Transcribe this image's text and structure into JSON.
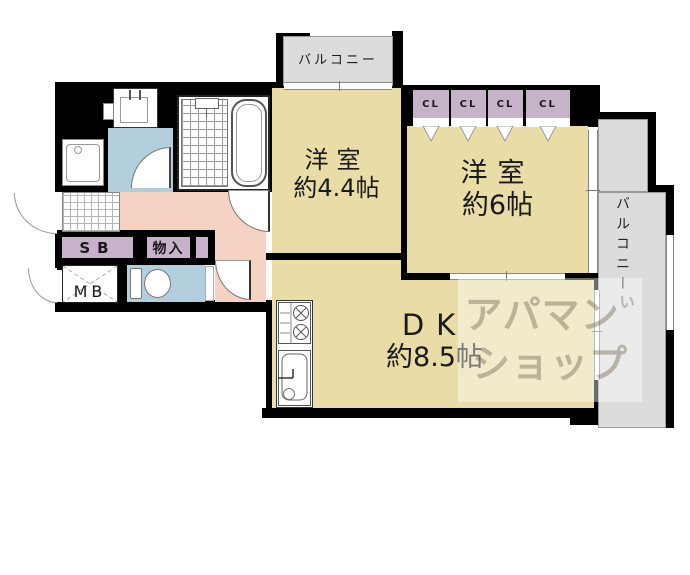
{
  "colors": {
    "wall": "#000000",
    "room": "#e9dca6",
    "closet": "#c6b2c9",
    "water": "#b3cedd",
    "hall": "#f5d2c2",
    "balcony": "#dcdcdc",
    "watermark_ink": "rgba(105,95,75,0.40)",
    "watermark_bg": "rgba(255,255,255,0.42)"
  },
  "labels": {
    "balcony_top": "バルコニー",
    "balcony_right": "バルコニー",
    "room_small_name": "洋室",
    "room_small_size": "約4.4帖",
    "room_large_name": "洋室",
    "room_large_size": "約6帖",
    "dk_name": "DK",
    "dk_size": "約8.5帖",
    "shoe_box": "SB",
    "storage": "物入",
    "meter_box": "MB"
  },
  "closets": {
    "items": [
      "CL",
      "CL",
      "CL",
      "CL"
    ]
  },
  "watermark": {
    "line1": "アパマン",
    "line2": "ショップ",
    "accent": "い"
  }
}
